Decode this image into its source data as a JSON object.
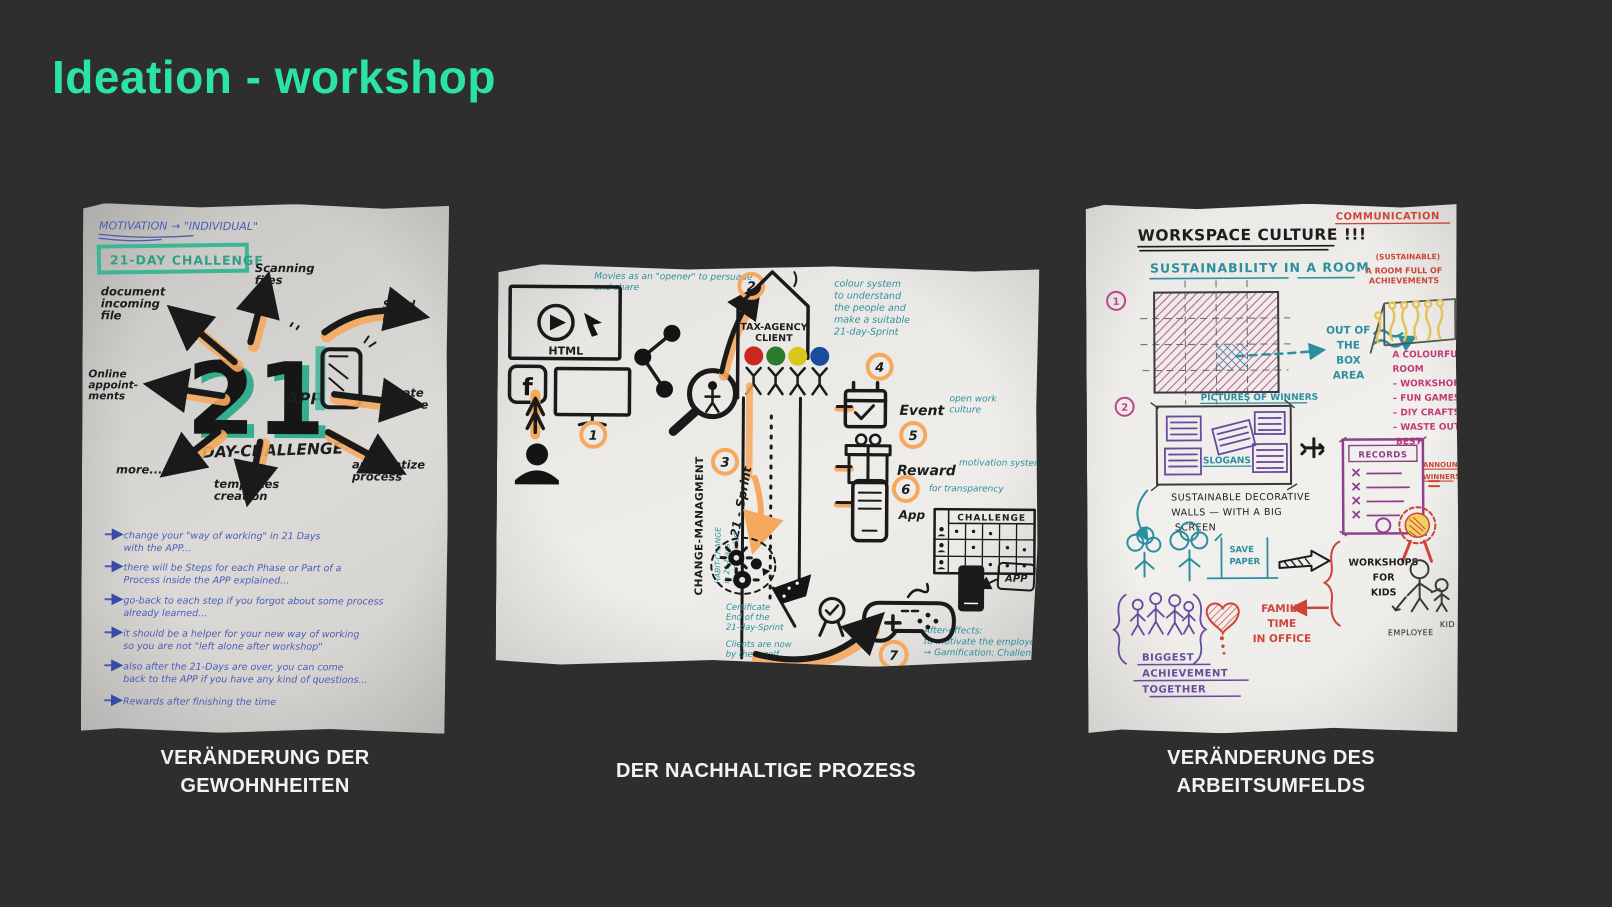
{
  "slide": {
    "title": "Ideation - workshop"
  },
  "colors": {
    "background": "#2e2e2f",
    "accent": "#2be3a6",
    "orange_highlight": "#f5a95f",
    "teal_marker": "#3db598",
    "teal_pen": "#2b8fa0",
    "blue_pen": "#4a5cb8",
    "magenta_pen": "#c23a77",
    "purple_pen": "#6a4a9e",
    "red_pen": "#cf4438",
    "black_ink": "#1a1a1a"
  },
  "paper1": {
    "caption": "VERÄNDERUNG DER GEWOHNHEITEN",
    "motivation_note": "MOTIVATION → \"INDIVIDUAL\"",
    "challenge_box": "21-DAY CHALLENGE",
    "big_number": "21",
    "app_label": "APP",
    "day_challenge": "DAY-CHALLENGE",
    "spokes": {
      "document": [
        "document",
        "incoming",
        "file"
      ],
      "scanning": [
        "Scanning",
        "files"
      ],
      "email": [
        "Send",
        "E-mail"
      ],
      "invoice": [
        "create",
        "invoice"
      ],
      "automatize": [
        "automatize",
        "process"
      ],
      "templates": [
        "templates",
        "creation"
      ],
      "more": "more...",
      "online": [
        "Online",
        "appoint-",
        "ments"
      ]
    },
    "bullets": [
      [
        "change your \"way of working\" in 21 Days",
        "with the APP..."
      ],
      [
        "there will be Steps for each Phase or Part of a",
        "Process inside the APP explained..."
      ],
      [
        "go-back to each step if you forgot about some process",
        "already learned..."
      ],
      [
        "it should be a helper for your new way of working",
        "so you are not \"left alone after workshop\""
      ],
      [
        "also after the 21-Days are over, you can come",
        "back to the APP if you have any kind of questions..."
      ],
      [
        "Rewards after finishing the time"
      ]
    ]
  },
  "paper2": {
    "caption": "DER NACHHALTIGE PROZESS",
    "movies_note": [
      "Movies as an \"opener\" to persuade",
      "and share"
    ],
    "html_label": "HTML",
    "facebook_f": "f",
    "badges": [
      "1",
      "2",
      "3",
      "4",
      "5",
      "6",
      "7"
    ],
    "sprint_label": "21 - Sprint",
    "change_mgmt": "CHANGE-MANAGMENT",
    "habit_note": [
      "HABIT-CHANGE",
      "in 21-Days",
      "Sprint-guided"
    ],
    "house_label": [
      "TAX-AGENCY",
      "CLIENT"
    ],
    "dot_colors": [
      "#c9281e",
      "#2c7a2e",
      "#d9c71b",
      "#174f9e"
    ],
    "colour_note": [
      "colour system",
      "to understand",
      "the people and",
      "make a suitable",
      "21-day-Sprint"
    ],
    "event_label": "Event",
    "event_note": [
      "open work",
      "culture"
    ],
    "reward_label": "Reward",
    "reward_note": "motivation system",
    "app_label": "App",
    "app_note": "for transparency",
    "challenge_header": "CHALLENGE",
    "app_small": "APP",
    "certificate_note": [
      "Certificate",
      "End of the",
      "21-day-Sprint"
    ],
    "clients_note": [
      "Clients are now",
      "by them self"
    ],
    "after_note": [
      "After-effects:",
      "to motivate the employees",
      "→ Gamification: Challenge"
    ]
  },
  "paper3": {
    "caption": "VERÄNDERUNG DES ARBEITSUMFELDS",
    "title": "WORKSPACE CULTURE !!!",
    "communication": "COMMUNICATION",
    "subtitle": "SUSTAINABILITY IN A ROOM",
    "badge1": "1",
    "badge2": "2",
    "out_of_box": [
      "OUT OF",
      "THE",
      "BOX",
      "AREA"
    ],
    "sustainable_paren": "(SUSTAINABLE)",
    "room_full": [
      "A ROOM FULL OF",
      "ACHIEVEMENTS"
    ],
    "colourful_list": [
      "A COLOURFUL",
      "ROOM",
      "–  WORKSHOPS",
      "–  FUN GAMES",
      "–  DIY CRAFTS",
      "–  WASTE  OUT OF",
      "      BEST"
    ],
    "pictures_of_winners": "PICTURES OF WINNERS",
    "slogans": "SLOGANS",
    "sustainable_walls": [
      "SUSTAINABLE   DECORATIVE",
      "WALLS  —  WITH  A  BIG",
      "            SCREEN"
    ],
    "records": "RECORDS",
    "announce": [
      "ANNOUNCE",
      "WINNERS"
    ],
    "save_paper": [
      "SAVE",
      "PAPER"
    ],
    "workshops_kids": [
      "WORKSHOPS",
      "FOR",
      "KIDS"
    ],
    "family_time": [
      "FAMILY",
      "TIME",
      "IN OFFICE"
    ],
    "biggest": [
      "BIGGEST",
      "ACHIEVEMENT",
      "TOGETHER"
    ],
    "employee": "EMPLOYEE",
    "kid": "KID"
  }
}
